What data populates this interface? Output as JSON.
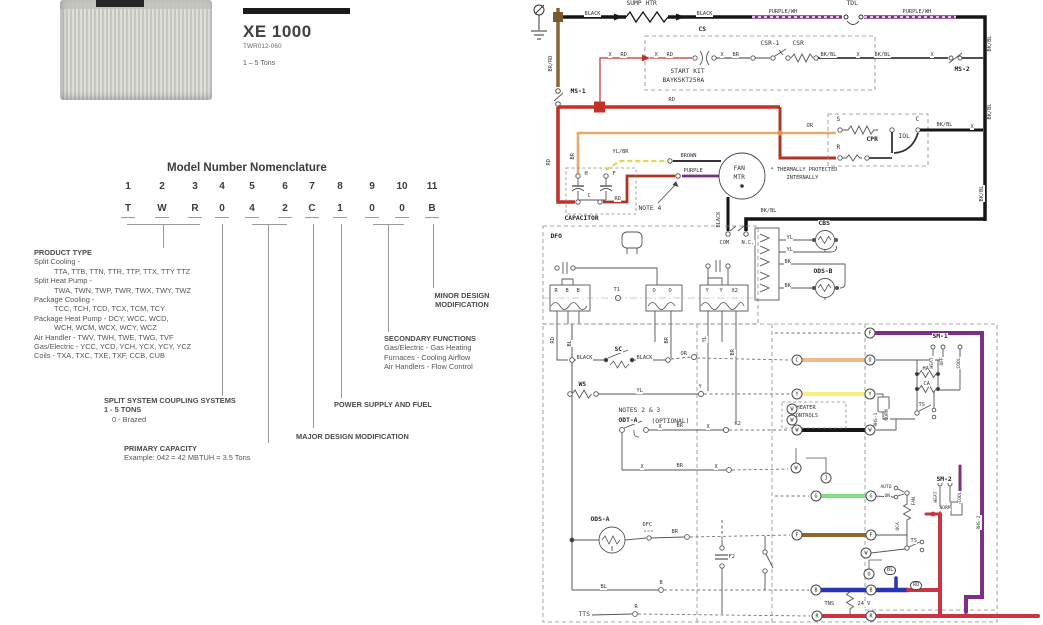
{
  "product": {
    "series": "XE 1000",
    "model_number": "TWR012-060",
    "capacity_range": "1 – 5 Tons"
  },
  "nomenclature": {
    "title": "Model Number Nomenclature",
    "positions": [
      "1",
      "2",
      "3",
      "4",
      "5",
      "6",
      "7",
      "8",
      "9",
      "10",
      "11"
    ],
    "code": [
      "T",
      "W",
      "R",
      "0",
      "4",
      "2",
      "C",
      "1",
      "0",
      "0",
      "B"
    ],
    "product_type": {
      "heading": "PRODUCT TYPE",
      "lines": [
        "Split Cooling -",
        "TTA, TTB, TTN, TTR, TTP, TTX, TTY TTZ",
        "Split Heat Pump -",
        "TWA, TWN, TWP, TWR, TWX, TWY, TWZ",
        "Package Cooling -",
        "TCC, TCH, TCD, TCX, TCM, TCY",
        "Package Heat Pump - DCY, WCC, WCD,",
        "WCH, WCM, WCX, WCY, WCZ",
        "Air Handler - TWV, TWH, TWE, TWG, TVF",
        "Gas/Electric - YCC, YCD, YCH, YCX, YCY, YCZ",
        "Coils - TXA, TXC, TXE, TXF, CCB, CUB"
      ]
    },
    "minor_design": {
      "line1": "MINOR DESIGN",
      "line2": "MODIFICATION"
    },
    "secondary_functions": {
      "heading": "SECONDARY FUNCTIONS",
      "lines": [
        "Gas/Electric - Gas Heating",
        "Furnaces - Cooling Airflow",
        "Air Handlers - Flow Control"
      ]
    },
    "split_system": {
      "heading": "SPLIT SYSTEM COUPLING SYSTEMS",
      "line1": "1 - 5 TONS",
      "line2": "0 - Brazed"
    },
    "power_supply": {
      "heading": "POWER SUPPLY AND FUEL"
    },
    "major_design": {
      "heading": "MAJOR DESIGN MODIFICATION"
    },
    "primary_capacity": {
      "heading": "PRIMARY CAPACITY",
      "example": "Example: 042 = 42 MBTUH = 3.5 Tons"
    }
  },
  "diagram": {
    "labels": [
      {
        "t": "SUMP HTR",
        "x": 96,
        "y": 0
      },
      {
        "t": "BLACK",
        "x": 54,
        "y": 11,
        "s": 5
      },
      {
        "t": "BLACK",
        "x": 166,
        "y": 11,
        "s": 5
      },
      {
        "t": "PURPLE/WH",
        "x": 238,
        "y": 9,
        "s": 5
      },
      {
        "t": "TDL",
        "x": 316,
        "y": 0
      },
      {
        "t": "PURPLE/WH",
        "x": 372,
        "y": 9,
        "s": 5
      },
      {
        "t": "BR/RD",
        "x": 18,
        "y": 72,
        "r": -90,
        "s": 5
      },
      {
        "t": "MS-1",
        "x": 40,
        "y": 88,
        "b": 1
      },
      {
        "t": "CS",
        "x": 168,
        "y": 26,
        "b": 1
      },
      {
        "t": "START KIT",
        "x": 140,
        "y": 68
      },
      {
        "t": "BAYKSKT250A",
        "x": 132,
        "y": 77
      },
      {
        "t": "CSR-1",
        "x": 230,
        "y": 40
      },
      {
        "t": "CSR",
        "x": 262,
        "y": 40
      },
      {
        "t": "X",
        "x": 78,
        "y": 52,
        "s": 5
      },
      {
        "t": "RD",
        "x": 90,
        "y": 52,
        "s": 5
      },
      {
        "t": "X",
        "x": 124,
        "y": 52,
        "s": 5
      },
      {
        "t": "RD",
        "x": 136,
        "y": 52,
        "s": 5
      },
      {
        "t": "X",
        "x": 190,
        "y": 52,
        "s": 5
      },
      {
        "t": "BR",
        "x": 202,
        "y": 52,
        "s": 5
      },
      {
        "t": "BK/BL",
        "x": 290,
        "y": 52,
        "s": 5
      },
      {
        "t": "X",
        "x": 326,
        "y": 52,
        "s": 5
      },
      {
        "t": "BK/BL",
        "x": 344,
        "y": 52,
        "s": 5
      },
      {
        "t": "X",
        "x": 400,
        "y": 52,
        "s": 5
      },
      {
        "t": "MS-2",
        "x": 424,
        "y": 66,
        "b": 1
      },
      {
        "t": "BK/BL",
        "x": 457,
        "y": 52,
        "r": -90,
        "s": 5
      },
      {
        "t": "BK/BL",
        "x": 457,
        "y": 120,
        "r": -90,
        "s": 5
      },
      {
        "t": "BK/BL",
        "x": 449,
        "y": 202,
        "r": -90,
        "s": 5
      },
      {
        "t": "RD",
        "x": 138,
        "y": 97,
        "s": 5
      },
      {
        "t": "RD",
        "x": 16,
        "y": 166,
        "r": -90,
        "s": 5
      },
      {
        "t": "BR",
        "x": 40,
        "y": 160,
        "r": -90,
        "s": 5
      },
      {
        "t": "YL/BR",
        "x": 82,
        "y": 149,
        "s": 5
      },
      {
        "t": "BROWN",
        "x": 150,
        "y": 153,
        "s": 5
      },
      {
        "t": "PURPLE",
        "x": 153,
        "y": 168,
        "s": 5
      },
      {
        "t": "FAN",
        "x": 203,
        "y": 165
      },
      {
        "t": "MTR",
        "x": 203,
        "y": 174
      },
      {
        "t": "NOTE 4",
        "x": 108,
        "y": 205
      },
      {
        "t": "* THERMALLY PROTECTED",
        "x": 240,
        "y": 167,
        "s": 5
      },
      {
        "t": "INTERNALLY",
        "x": 256,
        "y": 175,
        "s": 5
      },
      {
        "t": "S",
        "x": 306,
        "y": 116
      },
      {
        "t": "R",
        "x": 306,
        "y": 144
      },
      {
        "t": "C",
        "x": 385,
        "y": 116
      },
      {
        "t": "CPR",
        "x": 336,
        "y": 136,
        "b": 1
      },
      {
        "t": "IOL",
        "x": 368,
        "y": 133
      },
      {
        "t": "OR",
        "x": 276,
        "y": 123,
        "s": 5
      },
      {
        "t": "BK/BL",
        "x": 406,
        "y": 122,
        "s": 5
      },
      {
        "t": "X",
        "x": 440,
        "y": 124,
        "s": 5
      },
      {
        "t": "H",
        "x": 54,
        "y": 171,
        "s": 5
      },
      {
        "t": "F",
        "x": 82,
        "y": 171,
        "s": 5
      },
      {
        "t": "C",
        "x": 57,
        "y": 193,
        "s": 5
      },
      {
        "t": "CAPACITOR",
        "x": 34,
        "y": 215,
        "b": 1
      },
      {
        "t": "BLACK",
        "x": 186,
        "y": 228,
        "r": -90,
        "s": 5
      },
      {
        "t": "BK/BL",
        "x": 230,
        "y": 208,
        "s": 5
      },
      {
        "t": "COM",
        "x": 189,
        "y": 240,
        "s": 5
      },
      {
        "t": "N.C.",
        "x": 211,
        "y": 240,
        "s": 5
      },
      {
        "t": "RD",
        "x": 84,
        "y": 196,
        "s": 5
      },
      {
        "t": "DFO",
        "x": 20,
        "y": 233,
        "b": 1
      },
      {
        "t": "T1",
        "x": 83,
        "y": 287,
        "s": 5
      },
      {
        "t": "R",
        "x": 24,
        "y": 288,
        "s": 5
      },
      {
        "t": "B",
        "x": 35,
        "y": 288,
        "s": 5
      },
      {
        "t": "B",
        "x": 46,
        "y": 288,
        "s": 5
      },
      {
        "t": "O",
        "x": 122,
        "y": 288,
        "s": 5
      },
      {
        "t": "O",
        "x": 138,
        "y": 288,
        "s": 5
      },
      {
        "t": "Y",
        "x": 175,
        "y": 288,
        "s": 5
      },
      {
        "t": "Y",
        "x": 189,
        "y": 288,
        "s": 5
      },
      {
        "t": "X2",
        "x": 201,
        "y": 288,
        "s": 5
      },
      {
        "t": "RD",
        "x": 20,
        "y": 344,
        "r": -90,
        "s": 5
      },
      {
        "t": "BL",
        "x": 37,
        "y": 347,
        "r": -90,
        "s": 5
      },
      {
        "t": "BR",
        "x": 134,
        "y": 344,
        "r": -90,
        "s": 5
      },
      {
        "t": "YL",
        "x": 172,
        "y": 343,
        "r": -90,
        "s": 5
      },
      {
        "t": "BR",
        "x": 200,
        "y": 356,
        "r": -90,
        "s": 5
      },
      {
        "t": "CBS",
        "x": 288,
        "y": 220,
        "b": 1
      },
      {
        "t": "ODS-B",
        "x": 283,
        "y": 268,
        "b": 1
      },
      {
        "t": "YL",
        "x": 256,
        "y": 235,
        "s": 5
      },
      {
        "t": "YL",
        "x": 256,
        "y": 247,
        "s": 5
      },
      {
        "t": "BK",
        "x": 254,
        "y": 259,
        "s": 5
      },
      {
        "t": "BK",
        "x": 254,
        "y": 283,
        "s": 5
      },
      {
        "t": "SC",
        "x": 84,
        "y": 346,
        "b": 1
      },
      {
        "t": "BLACK",
        "x": 46,
        "y": 355,
        "s": 5
      },
      {
        "t": "BLACK",
        "x": 106,
        "y": 355,
        "s": 5
      },
      {
        "t": "OR",
        "x": 150,
        "y": 351,
        "s": 5
      },
      {
        "t": "WS",
        "x": 48,
        "y": 381,
        "b": 1
      },
      {
        "t": "YL",
        "x": 106,
        "y": 388,
        "s": 5
      },
      {
        "t": "Y",
        "x": 168,
        "y": 384,
        "s": 5
      },
      {
        "t": "NOTES 2 & 3",
        "x": 88,
        "y": 407
      },
      {
        "t": "ODT-A",
        "x": 88,
        "y": 417,
        "b": 1
      },
      {
        "t": "(OPTIONAL)",
        "x": 121,
        "y": 418
      },
      {
        "t": "X",
        "x": 128,
        "y": 424,
        "s": 5
      },
      {
        "t": "BR",
        "x": 146,
        "y": 423,
        "s": 5
      },
      {
        "t": "X",
        "x": 176,
        "y": 424,
        "s": 5
      },
      {
        "t": "K2",
        "x": 204,
        "y": 421,
        "s": 5
      },
      {
        "t": "X",
        "x": 110,
        "y": 464,
        "s": 5
      },
      {
        "t": "BR",
        "x": 146,
        "y": 463,
        "s": 5
      },
      {
        "t": "X",
        "x": 184,
        "y": 464,
        "s": 5
      },
      {
        "t": "ODS-A",
        "x": 60,
        "y": 516,
        "b": 1
      },
      {
        "t": "DFC",
        "x": 112,
        "y": 522,
        "s": 5
      },
      {
        "t": "BR",
        "x": 141,
        "y": 529,
        "s": 5
      },
      {
        "t": "BL",
        "x": 70,
        "y": 584,
        "s": 5
      },
      {
        "t": "B",
        "x": 129,
        "y": 580,
        "s": 5
      },
      {
        "t": "TTS",
        "x": 48,
        "y": 611
      },
      {
        "t": "R",
        "x": 104,
        "y": 604,
        "s": 5
      },
      {
        "t": "SM-1",
        "x": 402,
        "y": 333,
        "b": 1
      },
      {
        "t": "HEAT",
        "x": 400,
        "y": 369,
        "r": -90,
        "s": 4
      },
      {
        "t": "OFF",
        "x": 410,
        "y": 366,
        "r": -90,
        "s": 4
      },
      {
        "t": "COOL",
        "x": 427,
        "y": 369,
        "r": -90,
        "s": 4
      },
      {
        "t": "HA",
        "x": 392,
        "y": 366,
        "s": 5
      },
      {
        "t": "CA",
        "x": 393,
        "y": 381,
        "s": 5
      },
      {
        "t": "TS",
        "x": 388,
        "y": 402,
        "s": 5
      },
      {
        "t": "RHS-1",
        "x": 344,
        "y": 427,
        "r": -90,
        "s": 4
      },
      {
        "t": "NORM",
        "x": 355,
        "y": 421,
        "r": -90,
        "s": 4
      },
      {
        "t": "HEATER",
        "x": 266,
        "y": 405,
        "s": 5
      },
      {
        "t": "CONTROLS",
        "x": 262,
        "y": 413,
        "s": 5
      },
      {
        "t": "AUTO",
        "x": 350,
        "y": 485,
        "s": 4
      },
      {
        "t": "ON",
        "x": 354,
        "y": 494,
        "s": 4
      },
      {
        "t": "FAN",
        "x": 382,
        "y": 506,
        "r": -90,
        "s": 4
      },
      {
        "t": "OCA",
        "x": 366,
        "y": 531,
        "r": -90,
        "s": 4
      },
      {
        "t": "TS",
        "x": 380,
        "y": 538,
        "s": 5
      },
      {
        "t": "SM-2",
        "x": 406,
        "y": 476,
        "b": 1
      },
      {
        "t": "HEAT",
        "x": 404,
        "y": 503,
        "r": -90,
        "s": 4
      },
      {
        "t": "COOL",
        "x": 428,
        "y": 503,
        "r": -90,
        "s": 4
      },
      {
        "t": "NORM",
        "x": 409,
        "y": 506,
        "s": 4
      },
      {
        "t": "RHS-2",
        "x": 447,
        "y": 530,
        "r": -90,
        "s": 4
      },
      {
        "t": "BL",
        "x": 354,
        "y": 566,
        "tag": 1
      },
      {
        "t": "RD",
        "x": 380,
        "y": 581,
        "tag": 1
      },
      {
        "t": "TNS",
        "x": 294,
        "y": 601,
        "s": 5
      },
      {
        "t": "24 V",
        "x": 327,
        "y": 601,
        "s": 5
      },
      {
        "t": "F2",
        "x": 198,
        "y": 554,
        "s": 5
      }
    ],
    "terminals": [
      {
        "t": "F",
        "x": 340,
        "y": 333
      },
      {
        "t": "C",
        "x": 267,
        "y": 360
      },
      {
        "t": "O",
        "x": 340,
        "y": 360
      },
      {
        "t": "Y",
        "x": 267,
        "y": 394
      },
      {
        "t": "Y",
        "x": 340,
        "y": 394
      },
      {
        "t": "W",
        "x": 267,
        "y": 430
      },
      {
        "t": "W",
        "x": 340,
        "y": 430
      },
      {
        "t": "W",
        "x": 262,
        "y": 409
      },
      {
        "t": "W",
        "x": 262,
        "y": 420
      },
      {
        "t": "W",
        "x": 266,
        "y": 468
      },
      {
        "t": "J",
        "x": 296,
        "y": 478
      },
      {
        "t": "G",
        "x": 286,
        "y": 496
      },
      {
        "t": "G",
        "x": 341,
        "y": 496
      },
      {
        "t": "F",
        "x": 267,
        "y": 535
      },
      {
        "t": "F",
        "x": 341,
        "y": 535
      },
      {
        "t": "W",
        "x": 336,
        "y": 553
      },
      {
        "t": "U",
        "x": 339,
        "y": 574
      },
      {
        "t": "B",
        "x": 286,
        "y": 590
      },
      {
        "t": "B",
        "x": 341,
        "y": 590
      },
      {
        "t": "R",
        "x": 287,
        "y": 616
      },
      {
        "t": "R",
        "x": 341,
        "y": 616
      }
    ]
  },
  "colors": {
    "red_wire": "#c23128",
    "black_wire": "#161616",
    "purple_wire": "#7b2f86",
    "brown_wire": "#8a6434",
    "tan_wire": "#e9a968",
    "yellow_wire": "#f6ef7d",
    "orange_wire": "#f0bb88",
    "green_wire": "#82df7f",
    "blue_wire": "#2634b5",
    "lv_red_wire": "#cc3343"
  }
}
